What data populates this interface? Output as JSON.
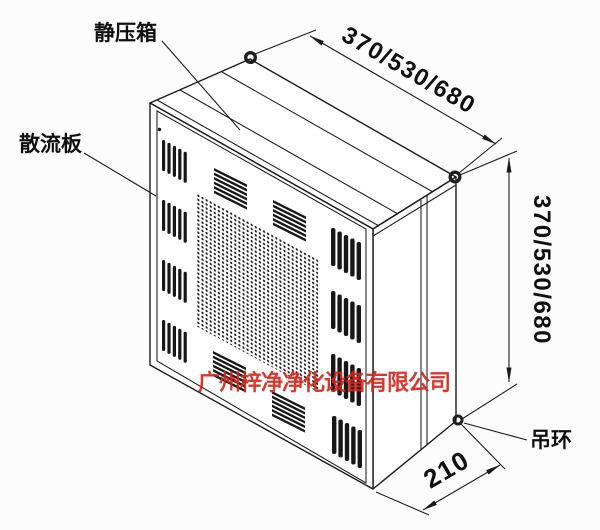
{
  "figure": {
    "type": "isometric technical drawing of clean-room plenum box (HEPA outlet)",
    "background": "#fcfcfc",
    "line_color": "#1b1b1b",
    "labels": {
      "plenum_box": "静压箱",
      "diffuser_plate": "散流板",
      "lifting_ring": "吊环"
    },
    "dimensions": {
      "top_width": "370/530/680",
      "side_height": "370/530/680",
      "bottom_depth": "210"
    },
    "watermark": {
      "text": "广州梓净净化设备有限公司",
      "color": "#d42418"
    }
  }
}
